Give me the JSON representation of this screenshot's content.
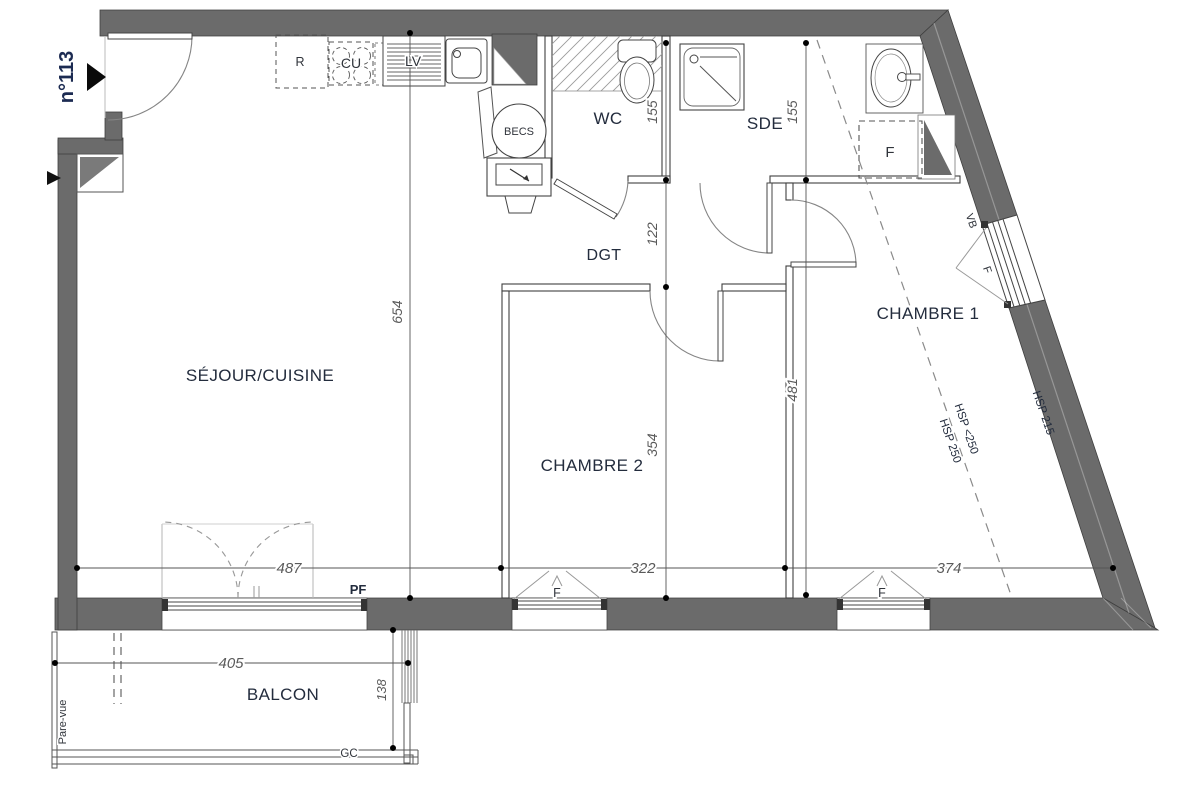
{
  "plan": {
    "unit_number": "n°113",
    "rooms": {
      "sejour": "SÉJOUR/CUISINE",
      "wc": "WC",
      "sde": "SDE",
      "dgt": "DGT",
      "chambre1": "CHAMBRE 1",
      "chambre2": "CHAMBRE 2",
      "balcon": "BALCON"
    },
    "fixtures": {
      "fridge": "R",
      "cooktop": "CU",
      "dishwasher": "LV",
      "water_heater": "BECS",
      "closet_sde": "F",
      "french_door": "PF",
      "window_ch2": "F",
      "window_ch1": "F",
      "window_slope_shutter": "VB",
      "window_slope": "F",
      "railing": "GC",
      "privacy_screen": "Pare-vue"
    },
    "dimensions": {
      "sejour_depth": "654",
      "wc_depth": "155",
      "hall_depth": "122",
      "chambre2_depth": "354",
      "sde_depth": "155",
      "chambre_depth": "481",
      "sejour_width": "487",
      "chambre2_width": "322",
      "chambre1_width": "374",
      "balcon_width": "405",
      "balcon_depth": "138"
    },
    "ceiling": {
      "hsp_low": "HSP <250",
      "hsp_mid": "HSP 250",
      "hsp_wall": "HSP 215"
    },
    "colors": {
      "wall": "#6b6b6b",
      "label": "#232c3d",
      "dim_text": "#5a5a5a",
      "unit_label": "#1c2b52"
    }
  }
}
